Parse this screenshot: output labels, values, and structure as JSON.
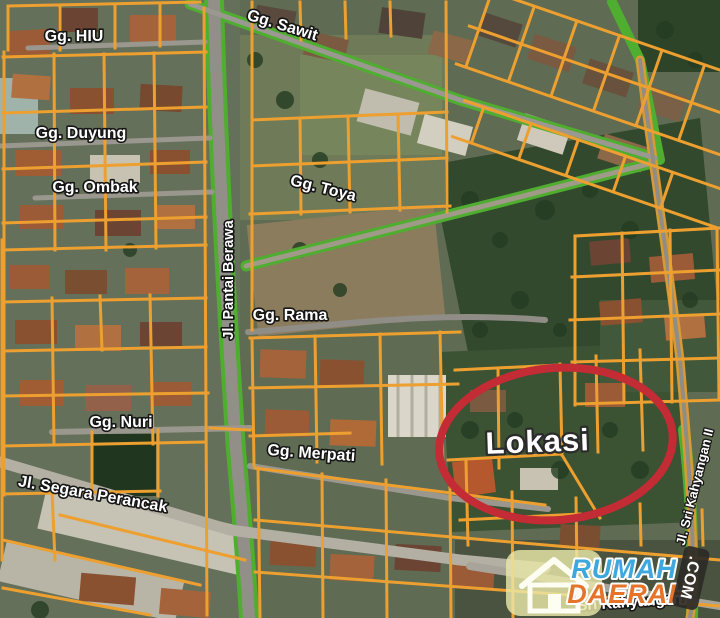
{
  "map": {
    "street_labels": {
      "gg_hiu": "Gg. HIU",
      "gg_sawit": "Gg. Sawit",
      "gg_duyung": "Gg. Duyung",
      "gg_ombak": "Gg. Ombak",
      "gg_toya": "Gg. Toya",
      "jl_pantai_berawa": "Jl. Pantai Berawa",
      "gg_rama": "Gg. Rama",
      "gg_nuri": "Gg. Nuri",
      "gg_merpati": "Gg. Merpati",
      "jl_segara_perancak": "Jl. Segara Perancak",
      "jl_sri_kahyangan_2": "Jl. Sri Kahyangan II",
      "sri_kahyangan": "Sri Kahyangan"
    },
    "location_marker": {
      "label": "Lokasi"
    },
    "colors": {
      "parcel_outline": "#EDA02F",
      "road_edge_green": "#4FAE2F",
      "highlight_ellipse": "#C32B35",
      "label_text": "#FFFFFF"
    }
  },
  "watermark": {
    "brand_top": "RUMAH",
    "brand_bottom": "DAERAH",
    "domain_suffix": ".COM",
    "brand_top_color": "#3EA7DD",
    "brand_bottom_color": "#E5742A"
  }
}
